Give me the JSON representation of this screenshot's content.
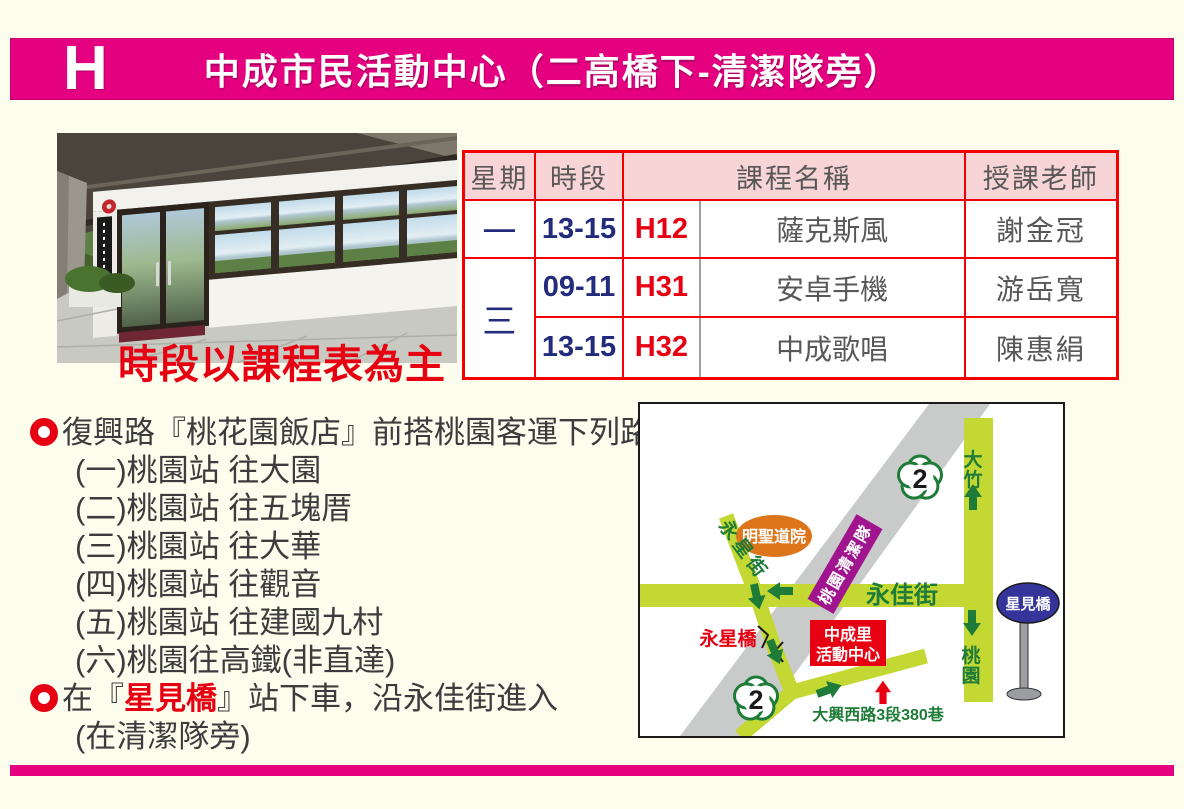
{
  "page": {
    "colors": {
      "bg": "#FDFDEE",
      "accent_pink": "#E4007F",
      "table_border_red": "#F40000",
      "table_header_bg": "#F7D4D6",
      "navy": "#232C7C",
      "gray_text": "#595757",
      "red_text": "#E60012"
    }
  },
  "header": {
    "letter": "H",
    "title": "中成市民活動中心（二高橋下-清潔隊旁）"
  },
  "photo": {
    "caption": "時段以課程表為主"
  },
  "schedule": {
    "headers": {
      "day": "星期",
      "time": "時段",
      "course": "課程名稱",
      "teacher": "授課老師"
    },
    "rows": [
      {
        "day": "一",
        "time": "13-15",
        "code": "H12",
        "course": "薩克斯風",
        "teacher": "謝金冠"
      },
      {
        "day": "三",
        "time": "09-11",
        "code": "H31",
        "course": "安卓手機",
        "teacher": "游岳寬"
      },
      {
        "time": "13-15",
        "code": "H32",
        "course": "中成歌唱",
        "teacher": "陳惠絹"
      }
    ]
  },
  "directions": {
    "intro": "復興路『桃花園飯店』前搭桃園客運下列路線",
    "routes": [
      "(一)桃園站 往大園",
      "(二)桃園站 往五塊厝",
      "(三)桃園站 往大華",
      "(四)桃園站 往觀音",
      "(五)桃園站 往建國九村",
      "(六)桃園往高鐵(非直達)"
    ],
    "stop_pre": "在『",
    "stop_highlight": "星見橋",
    "stop_post": "』站下車，沿永佳街進入",
    "stop_note": "(在清潔隊旁)"
  },
  "map": {
    "labels": {
      "route_number": "2",
      "dazhu_chars": [
        "大",
        "竹"
      ],
      "taoyuan_chars": [
        "桃",
        "園"
      ],
      "mingsheng_temple": "明聖道院",
      "yongxing_street": "永星街",
      "cleaning_squad": "桃園清潔隊",
      "yongjia_street": "永佳街",
      "xingjian_bridge": "星見橋",
      "yongxing_bridge": "永星橋",
      "center_line1": "中成里",
      "center_line2": "活動中心",
      "daxing_road": "大興西路3段380巷"
    },
    "colors": {
      "road": "#C3D832",
      "freeway": "#C9CACA",
      "arrow_green": "#1E7B38",
      "text_green": "#1E7B38",
      "purple": "#A0148E",
      "orange": "#DD751B",
      "red": "#E60012",
      "blue_sign": "#34349B",
      "pole_gray": "#9C9DA0"
    }
  }
}
